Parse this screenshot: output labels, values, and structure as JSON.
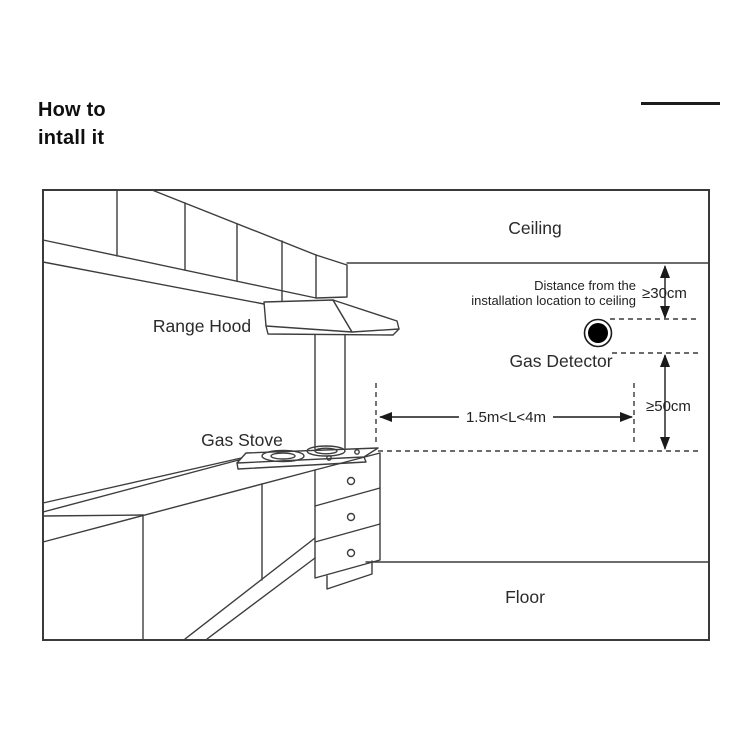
{
  "header": {
    "title_line1": "How to",
    "title_line2": "intall it"
  },
  "diagram": {
    "labels": {
      "ceiling": "Ceiling",
      "range_hood": "Range Hood",
      "gas_stove": "Gas Stove",
      "gas_detector": "Gas Detector",
      "floor": "Floor"
    },
    "annotations": {
      "distance_note_line1": "Distance from the",
      "distance_note_line2": "installation location to ceiling",
      "ceiling_clearance": "≥30cm",
      "wall_clearance": "≥50cm",
      "horizontal_range": "1.5m<L<4m"
    },
    "colors": {
      "line": "#3d3d3d",
      "text": "#2b2b2b",
      "detector_fill": "#000000",
      "background": "#ffffff"
    }
  }
}
